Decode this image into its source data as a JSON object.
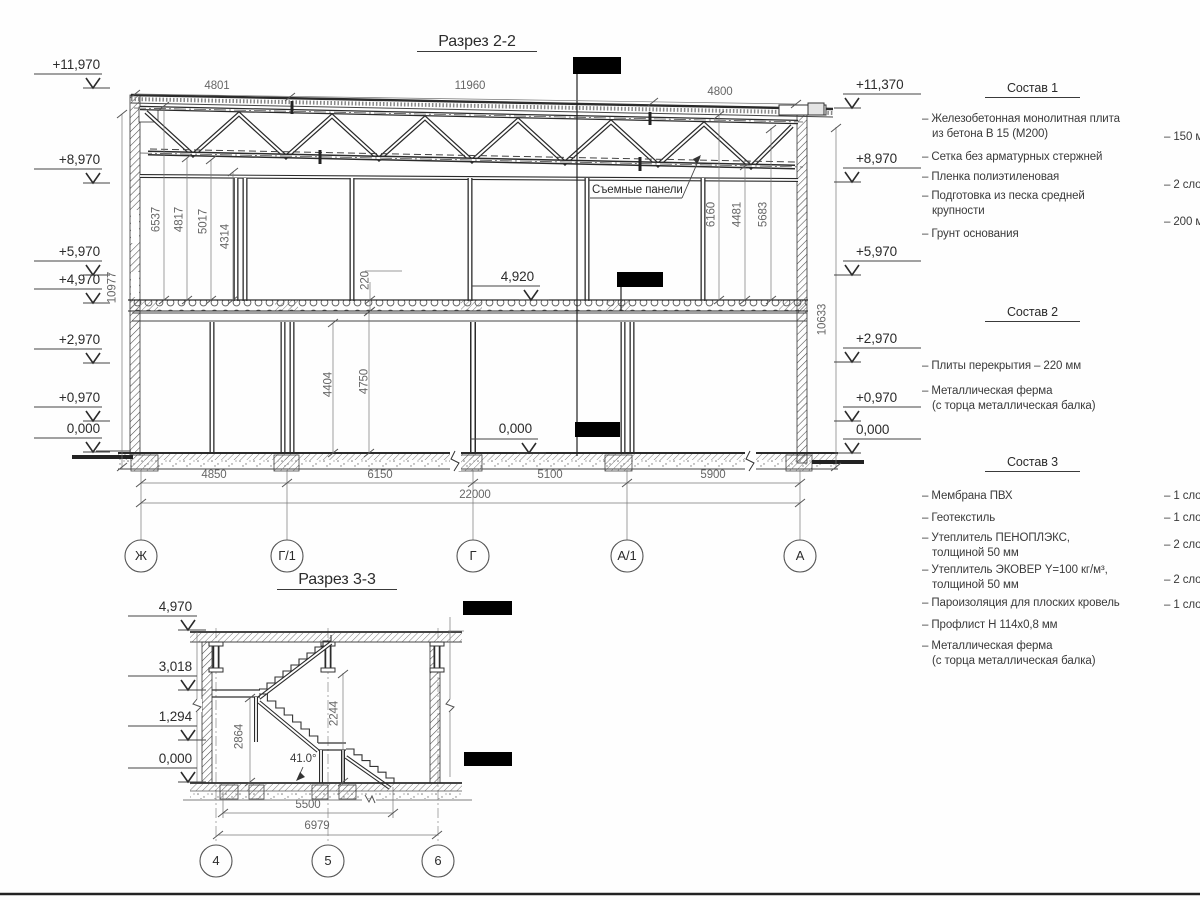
{
  "s22": {
    "title": "Разрез 2-2",
    "elev_left": [
      "+11,970",
      "+8,970",
      "+5,970",
      "+4,970",
      "+2,970",
      "+0,970",
      "0,000"
    ],
    "elev_right": [
      "+11,370",
      "+8,970",
      "+5,970",
      "+2,970",
      "+0,970",
      "0,000"
    ],
    "elev_mid_upper": "4,920",
    "elev_mid_lower": "0,000",
    "top_dims": [
      "4801",
      "11960",
      "4800"
    ],
    "vert_dims_left": [
      "6537",
      "4817",
      "5017",
      "4314"
    ],
    "vert_dims_right": [
      "6160",
      "4481",
      "5683"
    ],
    "slab_thickness": "220",
    "overall_left": "10977",
    "overall_right": "10633",
    "floor_heights": [
      "4404",
      "4750"
    ],
    "span_dims": [
      "4850",
      "6150",
      "5100",
      "5900"
    ],
    "total_span": "22000",
    "axes": [
      "Ж",
      "Г/1",
      "Г",
      "А/1",
      "А"
    ],
    "panels_label": "Съемные панели"
  },
  "s33": {
    "title": "Разрез 3-3",
    "elev_left": [
      "4,970",
      "3,018",
      "1,294",
      "0,000"
    ],
    "vert_dims": [
      "2864",
      "2244"
    ],
    "angle": "41.0°",
    "span_dims": [
      "5500",
      "6979"
    ],
    "axes": [
      "4",
      "5",
      "6"
    ]
  },
  "notes": {
    "comp1": {
      "title": "Состав 1",
      "items": [
        {
          "text": "– Железобетонная  монолитная плита\nиз бетона В 15 (М200)",
          "value": "– 150 мм"
        },
        {
          "text": "– Сетка без арматурных стержней",
          "value": ""
        },
        {
          "text": "– Пленка полиэтиленовая",
          "value": "– 2 слоя"
        },
        {
          "text": "– Подготовка из песка средней\nкрупности",
          "value": "– 200 мм"
        },
        {
          "text": "– Грунт основания",
          "value": ""
        }
      ]
    },
    "comp2": {
      "title": "Состав 2",
      "items": [
        {
          "text": "– Плиты перекрытия – 220 мм",
          "value": ""
        },
        {
          "text": "– Металлическая ферма\n(с торца металлическая балка)",
          "value": ""
        }
      ]
    },
    "comp3": {
      "title": "Состав 3",
      "items": [
        {
          "text": "– Мембрана ПВХ",
          "value": "– 1 слой"
        },
        {
          "text": "– Геотекстиль",
          "value": "– 1 слой"
        },
        {
          "text": "– Утеплитель ПЕНОПЛЭКС,\nтолщиной 50 мм",
          "value": "– 2 слоя"
        },
        {
          "text": "– Утеплитель ЭКОВЕР Y=100 кг/м³,\nтолщиной 50 мм",
          "value": "– 2 слоя"
        },
        {
          "text": "– Пароизоляция для плоских кровель",
          "value": "– 1 слой"
        },
        {
          "text": "– Профлист Н 114х0,8 мм",
          "value": ""
        },
        {
          "text": "– Металлическая ферма\n(с торца металлическая балка)",
          "value": ""
        }
      ]
    }
  }
}
